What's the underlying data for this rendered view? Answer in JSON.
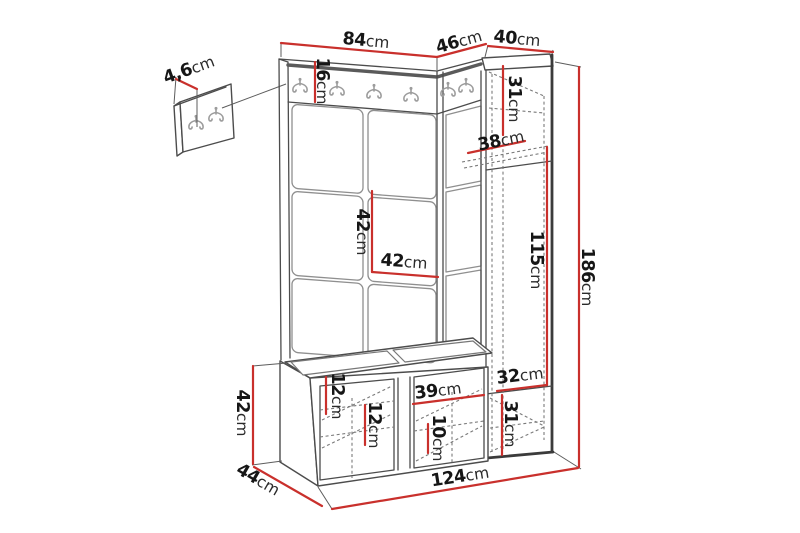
{
  "meta": {
    "type": "furniture-dimension-diagram",
    "subject": "hallway set: wall hook panel, upholstered panels, tall cabinet, shoe bench",
    "unit": "cm"
  },
  "colors": {
    "dimension_line": "#c9302c",
    "outline": "#4c4c4c",
    "hidden_edge": "#7a7a7a",
    "hook": "#9c9c9c",
    "text": "#161616"
  },
  "hooks": {
    "main_rail_count": 6,
    "small_panel_count": 2
  },
  "labels": {
    "w84": {
      "value": "84",
      "unit": "cm"
    },
    "w46": {
      "value": "46",
      "unit": "cm"
    },
    "w40": {
      "value": "40",
      "unit": "cm"
    },
    "t4_6": {
      "value": "4,6",
      "unit": "cm"
    },
    "h16": {
      "value": "16",
      "unit": "cm"
    },
    "h31_top": {
      "value": "31",
      "unit": "cm"
    },
    "d38": {
      "value": "38",
      "unit": "cm"
    },
    "h42_tile": {
      "value": "42",
      "unit": "cm"
    },
    "w42_tile": {
      "value": "42",
      "unit": "cm"
    },
    "h115": {
      "value": "115",
      "unit": "cm"
    },
    "h186": {
      "value": "186",
      "unit": "cm"
    },
    "h42_bench": {
      "value": "42",
      "unit": "cm"
    },
    "d44": {
      "value": "44",
      "unit": "cm"
    },
    "h12_a": {
      "value": "12",
      "unit": "cm"
    },
    "h12_b": {
      "value": "12",
      "unit": "cm"
    },
    "w39": {
      "value": "39",
      "unit": "cm"
    },
    "h10": {
      "value": "10",
      "unit": "cm"
    },
    "w32": {
      "value": "32",
      "unit": "cm"
    },
    "h31_bot": {
      "value": "31",
      "unit": "cm"
    },
    "w124": {
      "value": "124",
      "unit": "cm"
    }
  }
}
